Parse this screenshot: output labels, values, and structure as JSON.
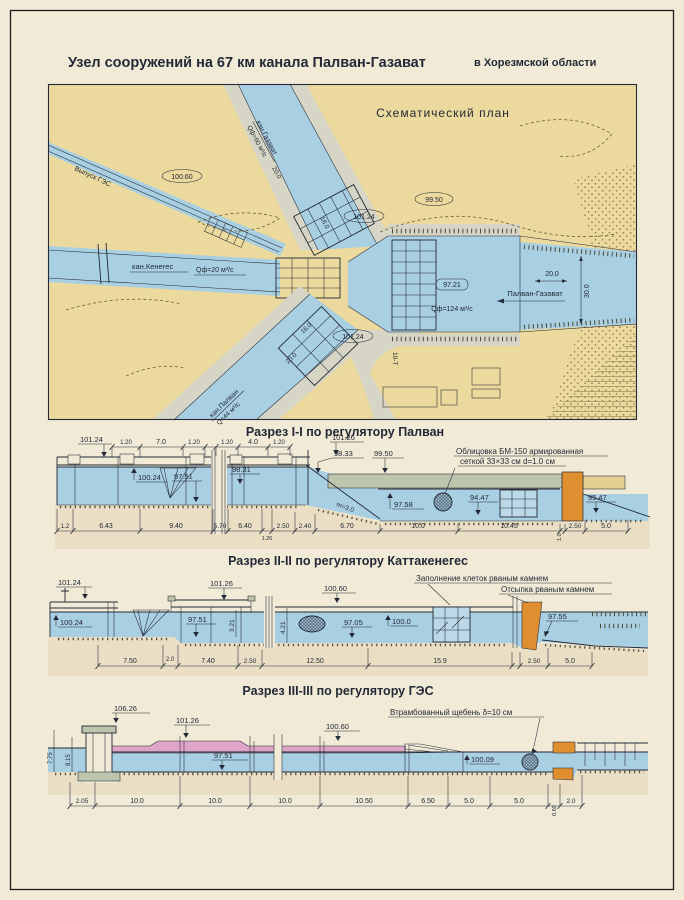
{
  "colors": {
    "paper": "#f1ead7",
    "land": "#ebd99d",
    "water": "#a9cfe2",
    "road": "#d7d5c6",
    "ink": "#232936",
    "pink": "#dfa5c7",
    "orange": "#e08f30",
    "lining": "#bdc5ac",
    "sand": "#eadfc5"
  },
  "title": {
    "main": "Узел  сооружений  на  67 км  канала  Палван-Газават",
    "region": "в Хорезмской области"
  },
  "map": {
    "title": "Схематический план",
    "gaz": "кан.Газават",
    "gaz_q": "Qф=60 м³/с",
    "ges": "Выпуск ГЭС",
    "ken": "кан.Кенегес",
    "ken_q": "Qф=20 м³/с",
    "pal": "кан.Палван",
    "pal_q": "Q=44 м³/с",
    "pg": "Палван-Газават",
    "pg_q": "Qф=124 м³/с",
    "e10060": "100.60",
    "e9950": "99.50",
    "e10124a": "101.24",
    "e10124b": "101.24",
    "e9721": "97.21",
    "d20g": "20.0",
    "d16g": "16.0",
    "d16p": "16.0",
    "d20p": "20.0",
    "d20m": "20.0",
    "d30m": "30.0",
    "road": "10-Т"
  },
  "s1": {
    "title": "Разрез I-I по регулятору Палван",
    "note1": "Облицовка БМ-150 армированная",
    "note2": "сеткой 33×33 см d=1.0 см",
    "slope": "m=3.0",
    "lv": {
      "a": "101.24",
      "b": "101.26",
      "c": "100.24",
      "d": "97.51",
      "e": "98.31",
      "f": "98.33",
      "g": "99.50",
      "h": "97.58",
      "i": "94.47",
      "j": "95.47"
    },
    "dt": [
      "1.20",
      "7.0",
      "1.20",
      "1.20",
      "4.0",
      "1.20"
    ],
    "db": [
      "1.2",
      "6.43",
      "9.40",
      "5.70",
      "6.40",
      "1.20",
      "2.50",
      "2.40",
      "6.70",
      "10.0",
      "10.45",
      "1.0",
      "2.50",
      "5.0"
    ]
  },
  "s2": {
    "title": "Разрез II-II по регулятору Каттакенегес",
    "note1": "Заполнение клеток рваным камнем",
    "note2": "Отсыпка рваным камнем",
    "lv": {
      "a": "101.24",
      "b": "100.24",
      "c": "101.26",
      "d": "97.51",
      "e": "100.60",
      "f": "97.05",
      "g": "100.0",
      "h": "97.55"
    },
    "dv": [
      "3.21",
      "4.21"
    ],
    "db": [
      "7.50",
      "2.0",
      "7.40",
      "2.50",
      "12.50",
      "15.9",
      "2.50",
      "5.0"
    ]
  },
  "s3": {
    "title": "Разрез III-III по регулятору ГЭС",
    "note1": "Втрамбованный щебень δ=10 см",
    "lv": {
      "a": "106.26",
      "b": "101.26",
      "c": "100.60",
      "d": "97.51",
      "e": "100.09"
    },
    "dv": [
      "7.75",
      "8.15"
    ],
    "db": [
      "2.05",
      "10.0",
      "10.0",
      "10.0",
      "10.50",
      "6.50",
      "5.0",
      "5.0",
      "0.60",
      "2.0"
    ]
  }
}
